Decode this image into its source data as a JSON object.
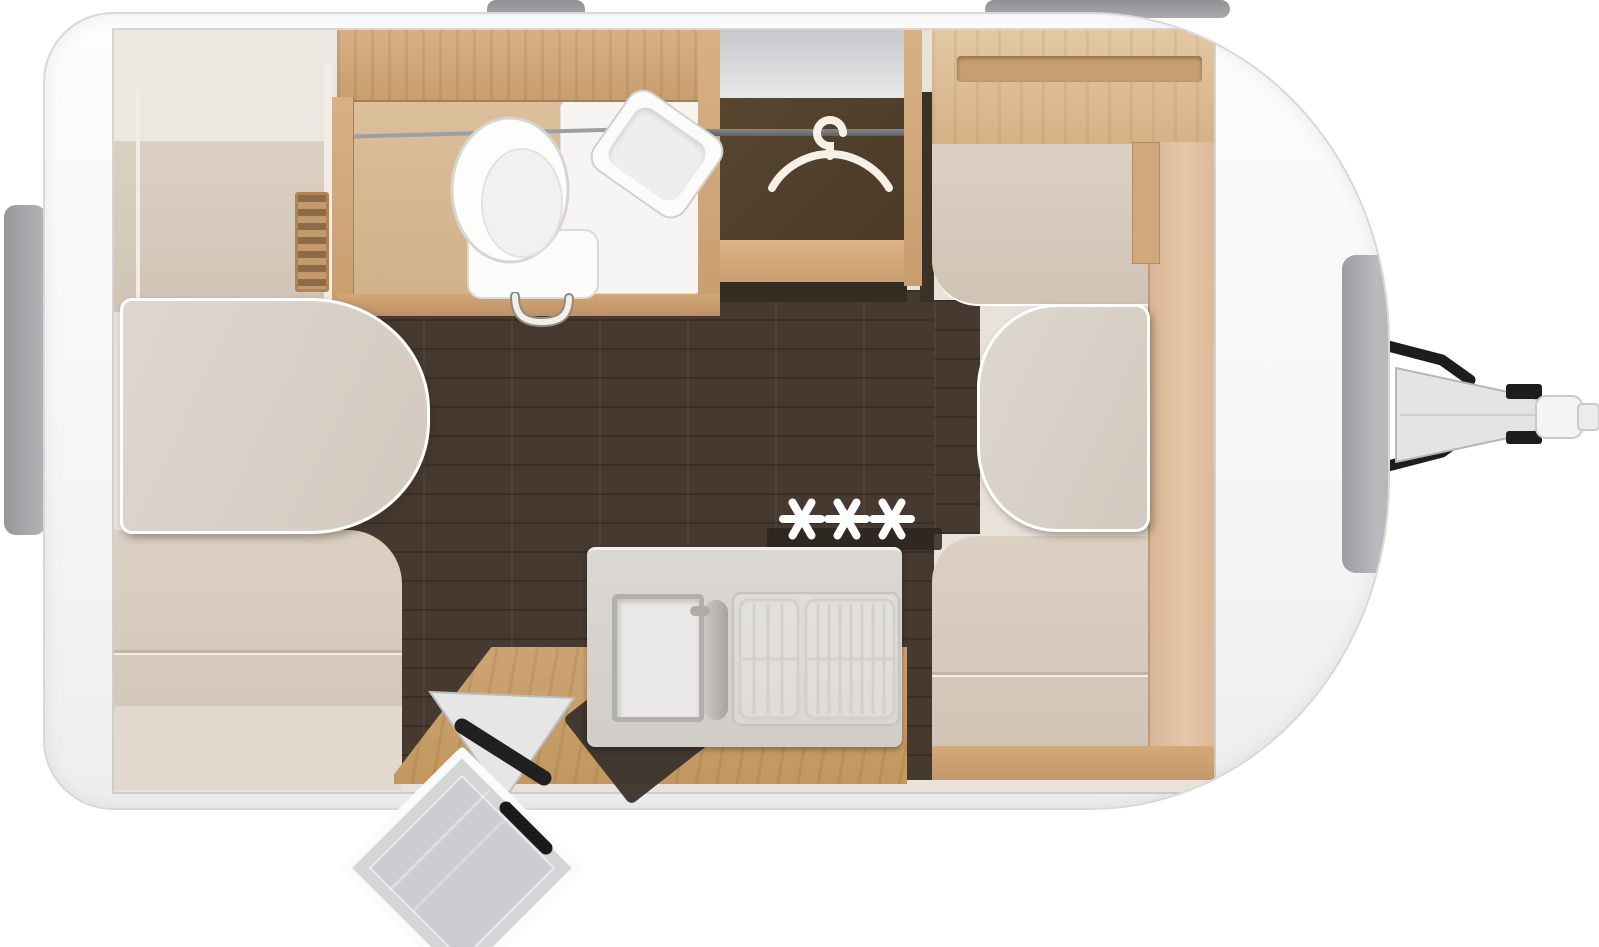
{
  "meta": {
    "title": "Caravan floor plan – top view",
    "diagram_type": "caravan-floorplan",
    "view": "top-down cutaway"
  },
  "areas": [
    {
      "id": "rear-dinette",
      "name": "Rear dinette: two upholstered benches with oval table"
    },
    {
      "id": "bathroom",
      "name": "Washroom with toilet, corner washbasin and shower tray"
    },
    {
      "id": "wardrobe",
      "name": "Wardrobe with clothes rail and hanger"
    },
    {
      "id": "front-dinette",
      "name": "Front dinette: two upholstered benches with table and side shelf"
    },
    {
      "id": "kitchen",
      "name": "Kitchen block with sink, faucet and gas hob"
    },
    {
      "id": "entrance",
      "name": "Entrance with open door, folding step and mat"
    },
    {
      "id": "drawbar",
      "name": "Drawbar with towing hitch and jockey wheel"
    }
  ],
  "fixtures": [
    "toilet",
    "washbasin",
    "shower-tray",
    "towel-rail",
    "wall-heater",
    "clothes-rail",
    "clothes-hanger",
    "dinette-table-rear",
    "dinette-table-front",
    "kitchen-sink",
    "kitchen-faucet",
    "hob-grates",
    "entry-door",
    "folding-step",
    "door-mat",
    "window-rear",
    "window-roof-left",
    "window-roof-right",
    "gas-locker",
    "hitch-coupling"
  ],
  "symbols": {
    "burner_glyph": "✳",
    "burner_count": 3,
    "hanger_icon": "clothes-hanger-icon"
  },
  "colors": {
    "page_bg": "#ffffff",
    "body_fill": "#f8f8f9",
    "body_edge": "#d7d8da",
    "window_gray": "#9a9c9f",
    "interior_base": "#e9e2da",
    "cushion_beige": "#d6c9bb",
    "table_gray": "#d8d1c8",
    "table_rim": "#ffffff",
    "wood_light": "#d8b084",
    "wood_mid": "#c89e6e",
    "sideboard_pink": "#e2bfa2",
    "floor_dark": "#463a30",
    "wardrobe_dark": "#52412d",
    "counter_gray": "#d7d3ce",
    "fixture_white": "#f8f7f5",
    "steel_gray": "#c9c7c4",
    "burner_white": "#ffffff",
    "hanger_white": "#f6f0e6",
    "hitch_gray": "#e3e4e5",
    "detail_black": "#1d1d1d"
  }
}
